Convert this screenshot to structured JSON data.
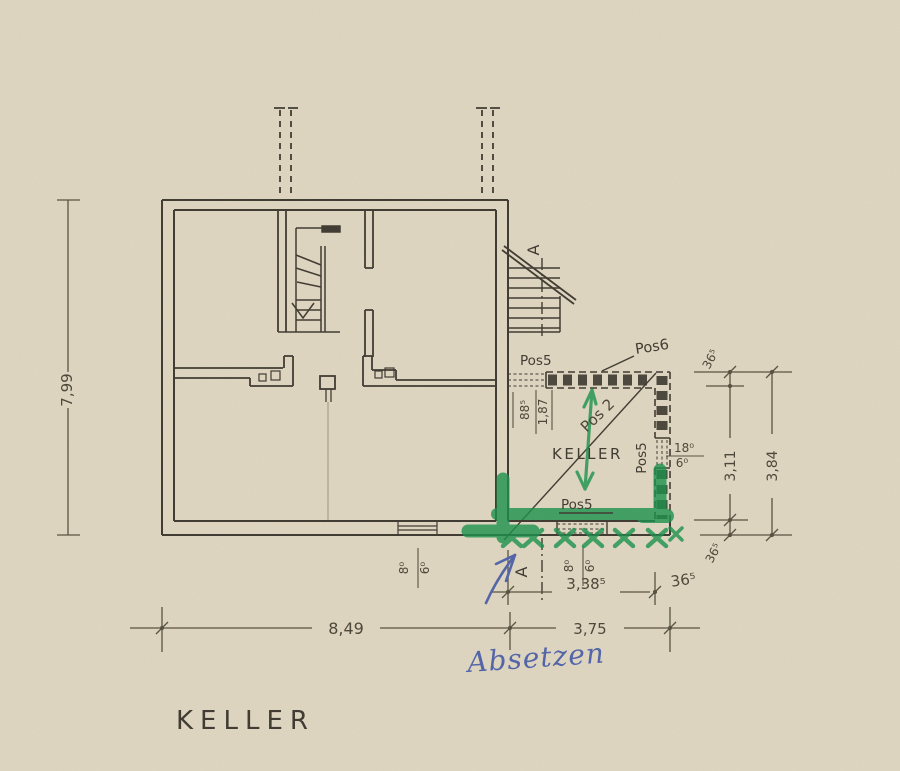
{
  "palette": {
    "paper": "#e3dac5",
    "ink": "#3d382f",
    "pencil": "#55503f",
    "green_marker": "#16934b",
    "blue_pen": "#5063ac"
  },
  "sheet": {
    "title": "KELLER"
  },
  "room": {
    "label": "KELLER"
  },
  "section": {
    "marker_top": "A",
    "marker_bottom": "A"
  },
  "positions": {
    "pos5_top_door": "Pos5",
    "pos6_new_walls": "Pos6",
    "pos5_right_window": "Pos5",
    "pos5_bottom_door": "Pos5",
    "pos2_green_note": "Pos 2"
  },
  "notes": {
    "blue_handwriting": "Absetzen"
  },
  "dimensions": {
    "overall_depth": "7,99",
    "overall_width": "8,49",
    "keller_outer_width": "3,75",
    "keller_inner_width": "3,38⁵",
    "keller_inner_depth": "3,11",
    "keller_outer_depth": "3,84",
    "wall_top_thickness": "36⁵",
    "wall_bottom_thickness": "36⁵",
    "wall_right_thickness": "36⁵",
    "top_door_width": "88⁵",
    "top_door_lintel": "1,87",
    "left_window_width": "8⁰",
    "left_window_height": "6⁰",
    "bottom_door_width": "8⁰",
    "bottom_door_height": "6⁰",
    "right_window_width": "18⁰",
    "right_window_height": "6⁰"
  }
}
